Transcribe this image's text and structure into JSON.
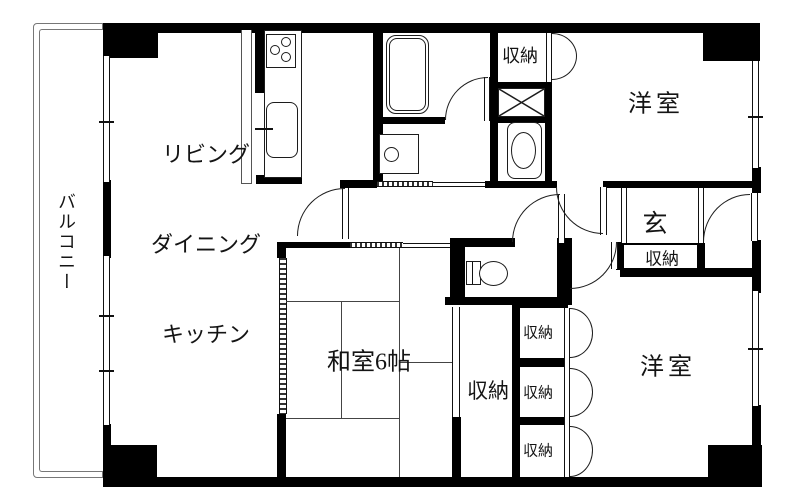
{
  "labels": {
    "balcony": "バルコニー",
    "ldk_line1": "リビング",
    "ldk_line2": "ダイニング",
    "ldk_line3": "キッチン",
    "japanese_room": "和室6帖",
    "western_room_top": "洋室",
    "western_room_bottom": "洋室",
    "entrance": "玄",
    "closet_entrance": "収納",
    "closet_top": "収納",
    "closet_tall": "収納",
    "closet_small_1": "収納",
    "closet_small_2": "収納",
    "closet_small_3": "収納"
  },
  "colors": {
    "wall": "#000000",
    "line": "#1c1c1c",
    "background": "#ffffff"
  }
}
